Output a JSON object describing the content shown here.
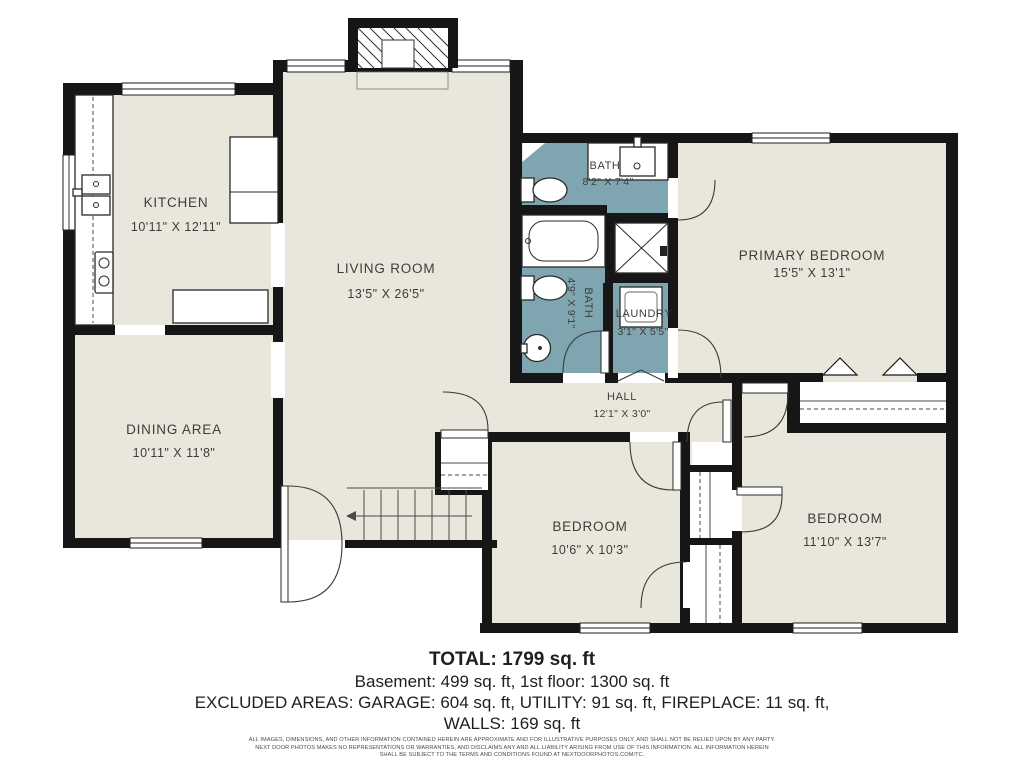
{
  "colors": {
    "floor": "#e9e6db",
    "bath": "#7fa6b0",
    "wall": "#161616",
    "label": "#3d3d3d",
    "line": "#2a2a2a"
  },
  "rooms": [
    {
      "id": "kitchen",
      "name": "KITCHEN",
      "dims": "10'11\" X 12'11\""
    },
    {
      "id": "living-room",
      "name": "LIVING ROOM",
      "dims": "13'5\" X 26'5\""
    },
    {
      "id": "bath-main",
      "name": "BATH",
      "dims": "8'2\" X 7'4\""
    },
    {
      "id": "primary-bedroom",
      "name": "PRIMARY BEDROOM",
      "dims": "15'5\" X 13'1\""
    },
    {
      "id": "dining-area",
      "name": "DINING AREA",
      "dims": "10'11\" X 11'8\""
    },
    {
      "id": "bath-hall",
      "name": "BATH",
      "dims": "4'9\" X 9'1\""
    },
    {
      "id": "laundry",
      "name": "LAUNDRY",
      "dims": "3'1\" X 5'5\""
    },
    {
      "id": "hall",
      "name": "HALL",
      "dims": "12'1\" X 3'0\""
    },
    {
      "id": "bedroom-middle",
      "name": "BEDROOM",
      "dims": "10'6\" X 10'3\""
    },
    {
      "id": "bedroom-right",
      "name": "BEDROOM",
      "dims": "11'10\" X 13'7\""
    }
  ],
  "summary": {
    "total": "TOTAL: 1799 sq. ft",
    "floors": "Basement: 499 sq. ft, 1st floor: 1300 sq. ft",
    "excluded": "EXCLUDED AREAS: GARAGE: 604 sq. ft, UTILITY: 91 sq. ft, FIREPLACE: 11 sq. ft,",
    "walls": "WALLS: 169 sq. ft"
  },
  "disclaimer": {
    "line1": "ALL IMAGES, DIMENSIONS, AND OTHER INFORMATION CONTAINED HEREIN ARE APPROXIMATE AND FOR ILLUSTRATIVE PURPOSES ONLY, AND SHALL NOT BE RELIED UPON BY ANY PARTY.",
    "line2": "NEXT DOOR PHOTOS MAKES NO REPRESENTATIONS OR WARRANTIES, AND DISCLAIMS ANY AND ALL LIABILITY ARISING FROM USE OF THIS INFORMATION. ALL INFORMATION HEREIN",
    "line3": "SHALL BE SUBJECT TO THE TERMS AND CONDITIONS FOUND AT NEXTDOORPHOTOS.COM/TC."
  }
}
